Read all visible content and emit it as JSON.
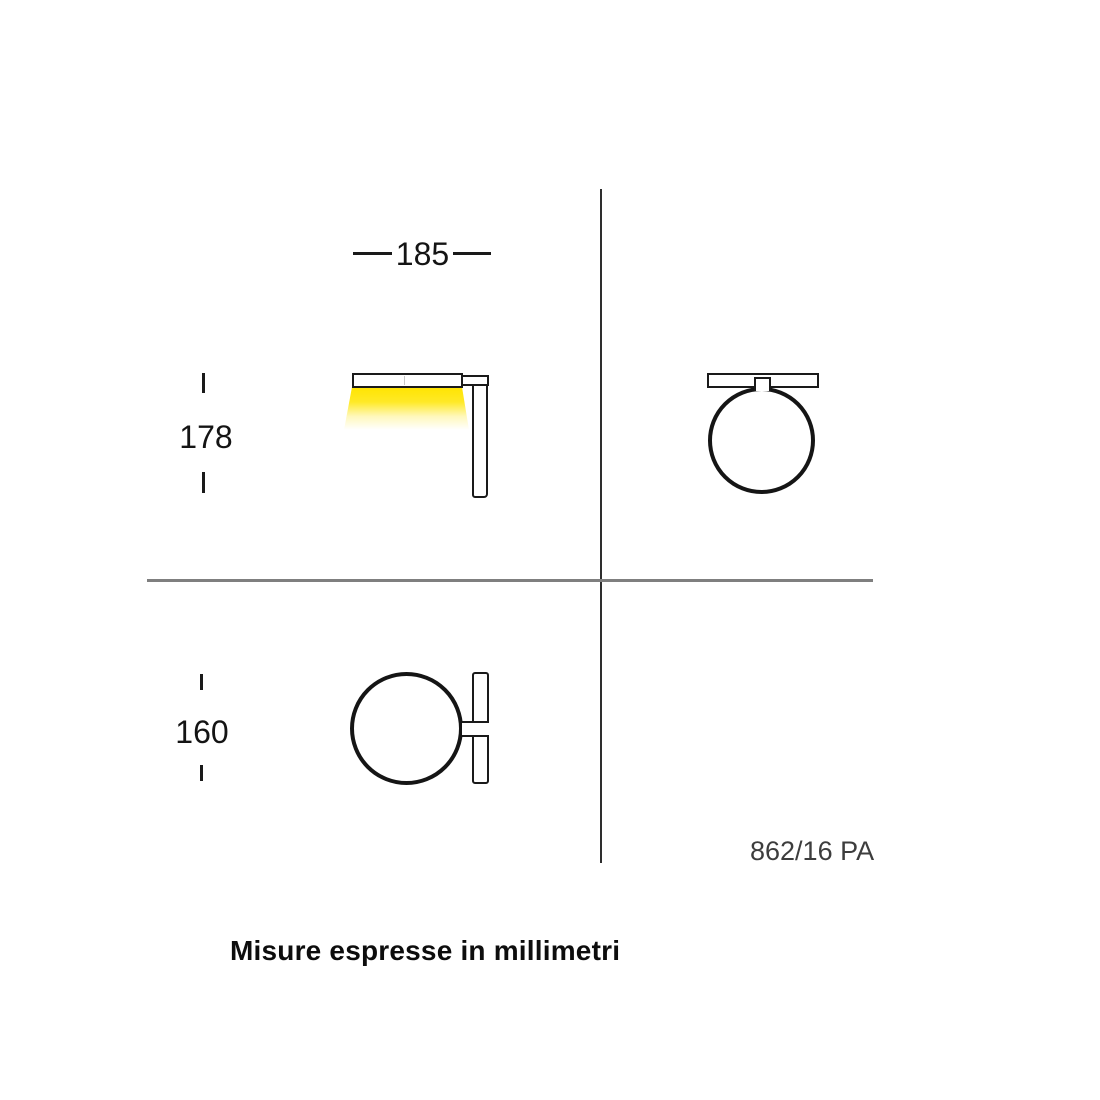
{
  "diagram": {
    "product_code": "862/16 PA",
    "note": "Misure espresse in millimetri",
    "dimensions": {
      "width": "185",
      "height": "178",
      "depth": "160"
    },
    "colors": {
      "line": "#1a1a1a",
      "beam_yellow": "#ffe400",
      "crosshair_vertical": "#2e2e2e",
      "crosshair_horizontal": "#7f7f7f",
      "code_text": "#3d3d3d",
      "background": "#ffffff"
    }
  }
}
